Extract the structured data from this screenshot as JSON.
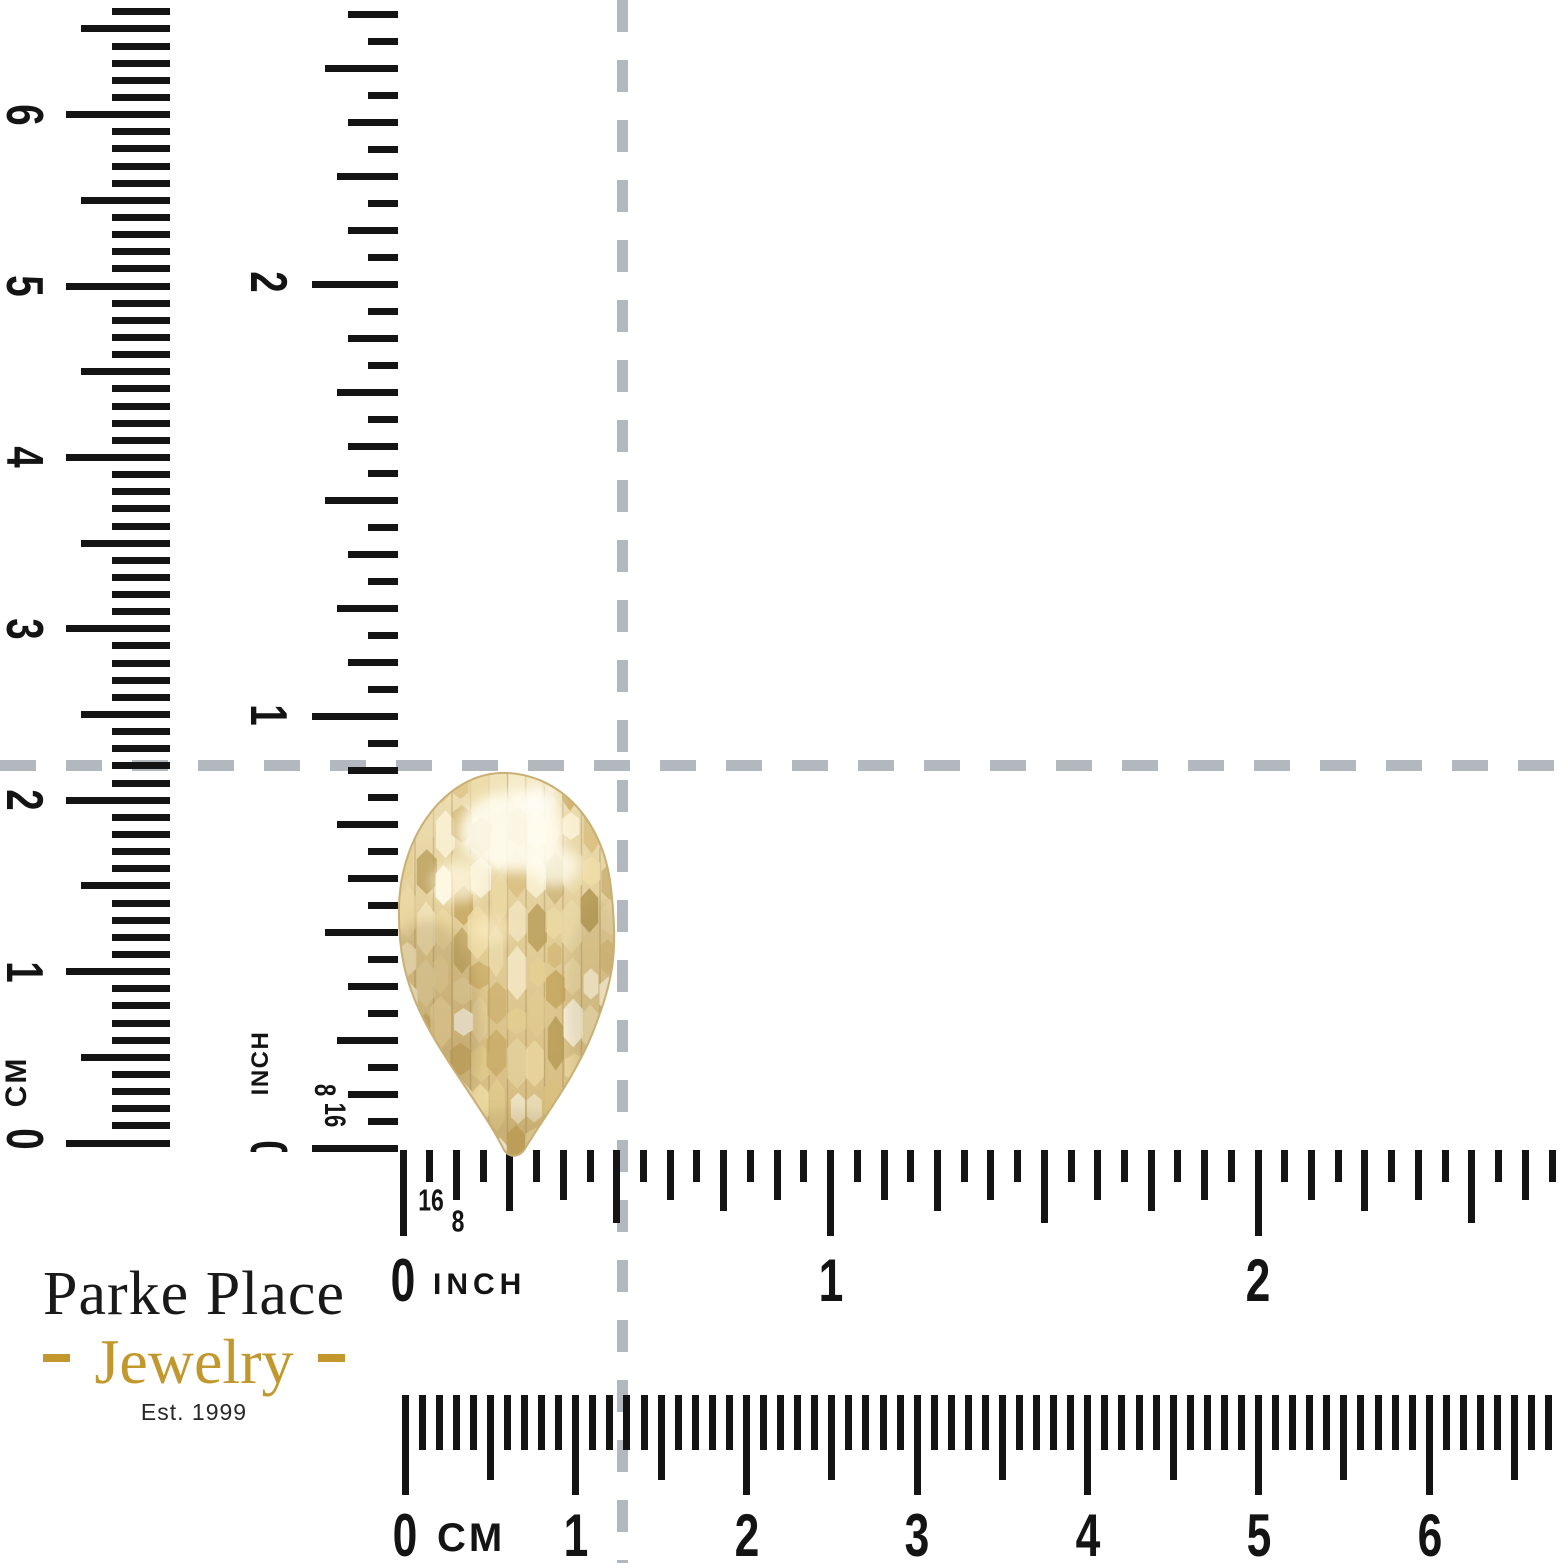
{
  "brand": {
    "line1": "Parke Place",
    "line2": "Jewelry",
    "established": "Est. 1999",
    "gold": "#c2982e",
    "ink": "#191919"
  },
  "rulers": {
    "left_cm_vertical": {
      "unit": "CM",
      "numbers": [
        "0",
        "1",
        "2",
        "3",
        "4",
        "5",
        "6"
      ]
    },
    "left_inch_vertical": {
      "unit": "INCH",
      "numbers": [
        "0",
        "1",
        "2"
      ],
      "fractions": [
        "8",
        "16"
      ]
    },
    "bottom_inch": {
      "unit": "INCH",
      "numbers": [
        "0",
        "1",
        "2"
      ],
      "fractions": [
        "16",
        "8"
      ]
    },
    "bottom_cm": {
      "unit": "CM",
      "numbers": [
        "0",
        "1",
        "2",
        "3",
        "4",
        "5",
        "6"
      ]
    }
  },
  "crosshair": {
    "color": "#b2b8be"
  },
  "item": {
    "name": "diamond-cut pear-shaped gold earring",
    "material_colors": {
      "base": "#e2cc96",
      "light": "#f6eac2",
      "bright": "#fffdf0",
      "mid": "#d9bf7f",
      "deep": "#c3a45c",
      "shadow": "#a78e52"
    }
  }
}
